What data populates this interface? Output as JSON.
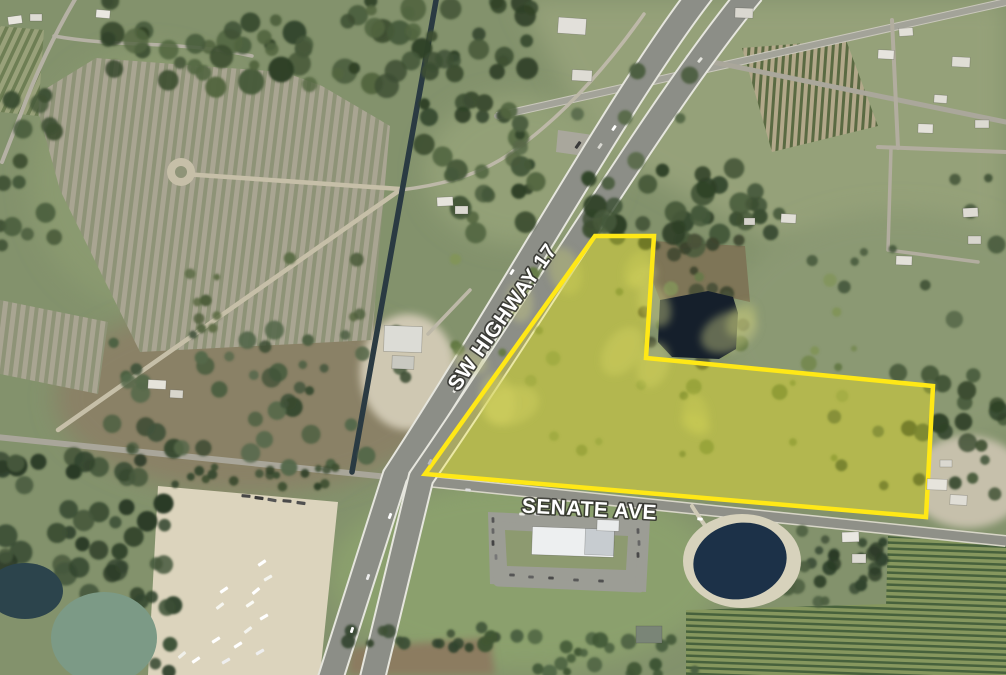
{
  "meta": {
    "title": "Aerial parcel map",
    "subject": "Vacant land parcel at SW Highway 17 and Senate Ave"
  },
  "labels": {
    "highway": {
      "text": "SW HIGHWAY 17",
      "x": 508,
      "y": 321,
      "rotate": -55,
      "size": 21
    },
    "street": {
      "text": "SENATE AVE",
      "x": 589,
      "y": 516,
      "rotate": 3,
      "size": 21
    }
  },
  "parcel": {
    "points": "425,474 595,236 654,236 646,358 933,386 926,517",
    "fill": "rgba(252,238,0,0.26)",
    "stroke": "#ffe816",
    "stroke_width": 4.5
  },
  "base_color": "#83926c",
  "patterns": [
    {
      "id": "pat-field",
      "size": 9,
      "bg": "#a9a592",
      "fg": "#8e9377",
      "fgw": 4,
      "rot": 7
    },
    {
      "id": "pat-corner",
      "size": 8,
      "bg": "#99a17a",
      "fg": "#6e7e54",
      "fgw": 3.5,
      "rot": 25
    },
    {
      "id": "pat-orch1",
      "size": 7,
      "bg": "#b2a88a",
      "fg": "#5a6a42",
      "fgw": 3,
      "rot": 4
    },
    {
      "id": "pat-orch2",
      "size": 6,
      "bg": "#86975e",
      "fg": "#47613c",
      "fgw": 2.5,
      "rot": 92
    }
  ],
  "patches": [
    {
      "name": "pasture-pale-ne",
      "shape": "poly",
      "pts": "520,0 1006,0 1006,255 770,240 600,150",
      "fill": "#95a179",
      "blur": 1
    },
    {
      "name": "pasture-right-mid",
      "shape": "ell",
      "c": [
        900,
        330,
        180,
        120
      ],
      "fill": "#8b9973",
      "blur": 1
    },
    {
      "name": "green-top-left",
      "shape": "ell",
      "c": [
        150,
        180,
        120,
        130
      ],
      "fill": "#8a9a70",
      "blur": 1
    },
    {
      "name": "pasture-brown",
      "shape": "ell",
      "c": [
        250,
        398,
        195,
        95
      ],
      "fill": "#8a8166",
      "blur": 1
    },
    {
      "name": "grass-ne-of-canal",
      "shape": "ell",
      "c": [
        520,
        170,
        95,
        75
      ],
      "fill": "#93a077",
      "blur": 1
    },
    {
      "name": "sand-barn-yard",
      "shape": "ell",
      "c": [
        408,
        372,
        48,
        58
      ],
      "fill": "#cfc8b2",
      "blur": 2
    },
    {
      "name": "grass-bottom",
      "shape": "ell",
      "c": [
        525,
        575,
        195,
        95
      ],
      "fill": "#8ba06d",
      "blur": 1
    },
    {
      "name": "sand-se-houses",
      "shape": "ell",
      "c": [
        968,
        482,
        58,
        46
      ],
      "fill": "#c6c0ab",
      "blur": 2
    },
    {
      "name": "dirt-bottom-strip",
      "shape": "poly",
      "pts": "350,648 490,638 495,675 348,675",
      "fill": "#8c7c60",
      "blur": 2
    },
    {
      "name": "staging-yard",
      "shape": "poly",
      "pts": "158,486 338,502 320,675 148,675",
      "fill": "#dcd4bd",
      "blur": 0
    },
    {
      "name": "highway-pulloff",
      "shape": "poly",
      "pts": "558,130 600,136 598,158 556,152",
      "fill": "#a9a79c",
      "blur": 0
    },
    {
      "name": "parcel-grass",
      "shape": "poly",
      "pts": "425,474 595,236 654,236 646,358 933,386 926,517",
      "fill": "#9aa46b",
      "blur": 0
    },
    {
      "name": "parking-lot",
      "shape": "poly",
      "pts": "488,512 650,520 646,592 490,584",
      "fill": "#9c9d95",
      "blur": 0
    },
    {
      "name": "parking-lawn",
      "shape": "poly",
      "pts": "505,530 628,536 626,570 507,566",
      "fill": "#8d9a70",
      "blur": 0
    },
    {
      "name": "marsh-north-pond",
      "shape": "poly",
      "pts": "652,241 745,246 750,302 710,293 660,300 653,282",
      "fill": "#7e7557",
      "blur": 0
    }
  ],
  "pattern_patches": [
    {
      "name": "plowed-field-main",
      "pts": "34,96 96,58 200,66 284,72 322,86 390,126 380,240 372,340 140,352 60,190",
      "pat": "pat-field"
    },
    {
      "name": "plowed-field-strip",
      "pts": "0,300 108,322 98,394 0,374",
      "pat": "pat-field"
    },
    {
      "name": "orchard-corner-nw",
      "pts": "0,26 44,30 38,116 0,112",
      "pat": "pat-corner"
    },
    {
      "name": "orchard-ne",
      "pts": "742,48 846,40 878,126 772,152",
      "pat": "pat-orch1"
    },
    {
      "name": "orchard-se-east",
      "pts": "888,536 1006,546 1006,675 884,675",
      "pat": "pat-orch2"
    },
    {
      "name": "orchard-se-west",
      "pts": "686,610 888,604 888,675 686,675",
      "pat": "pat-orch2"
    }
  ],
  "roads": [
    {
      "name": "corner-road-v",
      "d": "M77,-4 C58,28 38,68 20,116 L2,162",
      "w": 4,
      "color": "#b5b1a4"
    },
    {
      "name": "corner-road-h",
      "d": "M54,36 C120,48 180,40 252,56",
      "w": 3.5,
      "color": "#b5b1a4"
    },
    {
      "name": "senate-ave-west",
      "d": "M-4,437 L398,478",
      "w": 6,
      "color": "#a9a69a"
    },
    {
      "name": "dirt-road-field",
      "d": "M58,430 L400,190",
      "w": 4.5,
      "color": "#c6bfa8"
    },
    {
      "name": "dirt-road-turnaround-stem",
      "d": "M184,174 L400,189",
      "w": 4.5,
      "color": "#c6bfa8"
    },
    {
      "name": "dirt-turnaround-pad",
      "circle": [
        181,
        172,
        14
      ],
      "color": "#c6bfa8"
    },
    {
      "name": "dirt-turnaround-island",
      "circle": [
        181,
        172,
        6
      ],
      "color": "#8f9478"
    },
    {
      "name": "cross-road-top",
      "d": "M497,116 L1006,2",
      "w": 6,
      "color": "#a3a399",
      "cas": "#c9c7bb",
      "cw": 8
    },
    {
      "name": "branch-road-ne",
      "d": "M688,57 L1006,122",
      "w": 5,
      "color": "#aaa79b"
    },
    {
      "name": "residential-road-v",
      "d": "M892,20 L898,148",
      "w": 4,
      "color": "#b2ad9f"
    },
    {
      "name": "residential-road-h",
      "d": "M878,147 L1006,152",
      "w": 4,
      "color": "#b2ad9f"
    },
    {
      "name": "residential-drive",
      "d": "M891,148 L888,250 L978,262",
      "w": 3.5,
      "color": "#b2ad9f"
    },
    {
      "name": "frontage-road",
      "d": "M644,14 C610,62 560,122 500,160 C470,178 435,186 400,190 M470,290 L428,334",
      "w": 3.5,
      "color": "#bdb8a8"
    },
    {
      "name": "canal",
      "d": "M437,-5 L352,472",
      "w": 5.5,
      "color": "#2a3a42"
    },
    {
      "name": "senate-ave-east",
      "d": "M396,478 L1006,541",
      "w": 9,
      "color": "#8f9088",
      "cas": "#d8d6c8",
      "cw": 12
    },
    {
      "name": "highway-17-southbound",
      "d": "M702,-8 C622,95 510,300 395,476 L330,680",
      "w": 23,
      "color": "#8c8e87",
      "cas": "#e6e6de",
      "cw": 27
    },
    {
      "name": "highway-17-northbound",
      "d": "M752,-8 C662,100 536,312 421,478 L372,680",
      "w": 23,
      "color": "#8c8e87",
      "cas": "#e6e6de",
      "cw": 27
    },
    {
      "name": "pond-access-path",
      "d": "M692,506 C700,520 712,532 716,548",
      "w": 4,
      "color": "#cfcab6"
    },
    {
      "name": "office-driveway-west",
      "d": "M560,506 L562,521",
      "w": 5,
      "color": "#9c9d95"
    },
    {
      "name": "office-driveway-east",
      "d": "M620,510 L623,524",
      "w": 5,
      "color": "#9c9d95"
    },
    {
      "name": "office-parking-loop",
      "d": "M497,517 L642,524 L640,588 L498,582 Z",
      "w": 9,
      "color": "#9c9d95"
    }
  ],
  "waters": [
    {
      "name": "retention-pond-parcel",
      "shape": "poly",
      "pts": "660,300 708,291 733,297 738,313 736,349 719,359 672,357 658,342",
      "fill": "#151f2b"
    },
    {
      "name": "pond-sand-ring",
      "shape": "ell",
      "c": [
        742,
        561,
        59,
        47
      ],
      "fill": "#d7d2bc"
    },
    {
      "name": "pond-office",
      "shape": "ell",
      "c": [
        740,
        561,
        47,
        38
      ],
      "fill": "#1c3148",
      "rot": -12
    },
    {
      "name": "pond-teal-sw",
      "shape": "ell",
      "c": [
        104,
        638,
        53,
        46
      ],
      "fill": "#7c9a86"
    },
    {
      "name": "pond-dark-sw",
      "shape": "ell",
      "c": [
        25,
        591,
        38,
        28
      ],
      "fill": "#2c444c"
    }
  ],
  "veg_clusters": [
    {
      "name": "trees-top-strip",
      "box": [
        108,
        0,
        330,
        88
      ],
      "n": 55,
      "r": [
        5,
        13
      ],
      "cols": [
        "#3c4e32",
        "#46593a",
        "#2f4128",
        "#526540"
      ],
      "seed": 11
    },
    {
      "name": "trees-canal-top",
      "box": [
        430,
        0,
        112,
        80
      ],
      "n": 20,
      "r": [
        5,
        11
      ],
      "cols": [
        "#3c4e32",
        "#46593a",
        "#2f4128"
      ],
      "seed": 22
    },
    {
      "name": "trees-canal-mid",
      "box": [
        424,
        95,
        122,
        145
      ],
      "n": 30,
      "r": [
        5,
        11
      ],
      "cols": [
        "#3c4e32",
        "#46593a",
        "#2f4128",
        "#526540"
      ],
      "seed": 33
    },
    {
      "name": "trees-left-edge",
      "box": [
        0,
        92,
        62,
        170
      ],
      "n": 15,
      "r": [
        5,
        10
      ],
      "cols": [
        "#3c4e32",
        "#46593a"
      ],
      "seed": 44
    },
    {
      "name": "bushes-field",
      "box": [
        190,
        255,
        170,
        80
      ],
      "n": 12,
      "r": [
        3,
        7
      ],
      "cols": [
        "#5c6b45",
        "#4e5e3c"
      ],
      "seed": 55
    },
    {
      "name": "trees-pasture",
      "box": [
        112,
        325,
        300,
        145
      ],
      "n": 48,
      "r": [
        4,
        10
      ],
      "cols": [
        "#41523a",
        "#4c5f41",
        "#37482f",
        "#55684a"
      ],
      "seed": 66
    },
    {
      "name": "trees-north-parcel",
      "box": [
        588,
        168,
        200,
        78
      ],
      "n": 40,
      "r": [
        6,
        12
      ],
      "cols": [
        "#3c4e32",
        "#46593a",
        "#2f4128"
      ],
      "seed": 77
    },
    {
      "name": "trees-pond-ring",
      "box": [
        644,
        236,
        112,
        132
      ],
      "n": 20,
      "r": [
        4,
        8
      ],
      "cols": [
        "#4a5138",
        "#3c442e"
      ],
      "seed": 88
    },
    {
      "name": "trees-east-parcel",
      "box": [
        930,
        372,
        76,
        112
      ],
      "n": 15,
      "r": [
        5,
        10
      ],
      "cols": [
        "#3c4e32",
        "#46593a",
        "#2f4128"
      ],
      "seed": 99
    },
    {
      "name": "trees-right-scatter",
      "box": [
        812,
        165,
        194,
        335
      ],
      "n": 22,
      "r": [
        4,
        9
      ],
      "cols": [
        "#4d5f41",
        "#56694a",
        "#44553a"
      ],
      "seed": 101
    },
    {
      "name": "trees-ne-pasture",
      "box": [
        520,
        55,
        210,
        125
      ],
      "n": 8,
      "r": [
        5,
        9
      ],
      "cols": [
        "#4c5e40",
        "#556847"
      ],
      "seed": 103
    },
    {
      "name": "scrub-bottom-left",
      "box": [
        0,
        452,
        172,
        145
      ],
      "n": 45,
      "r": [
        6,
        12
      ],
      "cols": [
        "#33452e",
        "#2b3b27",
        "#3d5036",
        "#46583c"
      ],
      "seed": 107
    },
    {
      "name": "scrub-bottom-left-2",
      "box": [
        130,
        595,
        50,
        80
      ],
      "n": 8,
      "r": [
        5,
        9
      ],
      "cols": [
        "#33452e",
        "#3d5036"
      ],
      "seed": 109
    },
    {
      "name": "hedgerow-yard",
      "box": [
        175,
        467,
        175,
        20
      ],
      "n": 18,
      "r": [
        3,
        5
      ],
      "cols": [
        "#3c4e32",
        "#2f4128"
      ],
      "seed": 113
    },
    {
      "name": "tree-row-bottom",
      "box": [
        348,
        626,
        150,
        22
      ],
      "n": 16,
      "r": [
        4,
        7
      ],
      "cols": [
        "#33452e",
        "#3d5036"
      ],
      "seed": 127
    },
    {
      "name": "hedge-bottom-center",
      "box": [
        485,
        635,
        210,
        40
      ],
      "n": 24,
      "r": [
        4,
        8
      ],
      "cols": [
        "#3f5534",
        "#4a6040"
      ],
      "seed": 131
    },
    {
      "name": "bushes-parcel",
      "box": [
        455,
        255,
        400,
        210
      ],
      "n": 34,
      "r": [
        3,
        8
      ],
      "cols": [
        "#74884e",
        "#647a46",
        "#82945a"
      ],
      "seed": 137
    },
    {
      "name": "trees-office-pond",
      "box": [
        780,
        512,
        72,
        95
      ],
      "n": 12,
      "r": [
        4,
        8
      ],
      "cols": [
        "#41523a",
        "#4c5f41"
      ],
      "seed": 139
    },
    {
      "name": "trees-farmstead-se",
      "box": [
        820,
        542,
        68,
        66
      ],
      "n": 16,
      "r": [
        4,
        8
      ],
      "cols": [
        "#33452e",
        "#2b3b27",
        "#3d5036"
      ],
      "seed": 149
    }
  ],
  "blotches": {
    "name": "parcel-grass-highlights",
    "box": [
      470,
      268,
      390,
      190
    ],
    "n": 14,
    "r": [
      14,
      32
    ],
    "cols": [
      "#c6c882",
      "#bac073"
    ],
    "seed": 171,
    "op": 0.45
  },
  "buildings": [
    [
      8,
      16,
      14,
      8,
      -8,
      "#e8e6de"
    ],
    [
      30,
      14,
      12,
      7,
      0,
      "#dddbd3"
    ],
    [
      96,
      10,
      14,
      8,
      5,
      "#e9e7e1"
    ],
    [
      384,
      326,
      38,
      26,
      2,
      "#dcdcd6"
    ],
    [
      392,
      356,
      22,
      13,
      2,
      "#c9c9c1"
    ],
    [
      437,
      197,
      16,
      9,
      -3,
      "#e6e4dc"
    ],
    [
      455,
      206,
      13,
      8,
      0,
      "#dcdad2"
    ],
    [
      148,
      380,
      18,
      9,
      3,
      "#e5e3da"
    ],
    [
      170,
      390,
      13,
      8,
      3,
      "#d8d6cc"
    ],
    [
      558,
      18,
      28,
      16,
      4,
      "#e2e0da"
    ],
    [
      572,
      70,
      20,
      11,
      3,
      "#dedcd4"
    ],
    [
      735,
      8,
      18,
      10,
      2,
      "#dad8d0"
    ],
    [
      878,
      50,
      16,
      9,
      3,
      "#e6e4de"
    ],
    [
      899,
      28,
      14,
      8,
      -4,
      "#e2e0d8"
    ],
    [
      952,
      57,
      18,
      10,
      3,
      "#dfddd5"
    ],
    [
      918,
      124,
      15,
      9,
      2,
      "#e4e2da"
    ],
    [
      975,
      120,
      14,
      8,
      0,
      "#dcdad2"
    ],
    [
      934,
      95,
      13,
      8,
      4,
      "#e0ded6"
    ],
    [
      896,
      256,
      16,
      9,
      2,
      "#e3e1d9"
    ],
    [
      963,
      208,
      15,
      9,
      -3,
      "#dedcd4"
    ],
    [
      968,
      236,
      13,
      8,
      0,
      "#d8d6ce"
    ],
    [
      781,
      214,
      15,
      9,
      3,
      "#e1dfd7"
    ],
    [
      744,
      218,
      11,
      7,
      0,
      "#d6d4cc"
    ],
    [
      927,
      479,
      20,
      11,
      2,
      "#e6e4dc"
    ],
    [
      950,
      495,
      17,
      10,
      3,
      "#e0ded6"
    ],
    [
      940,
      460,
      12,
      7,
      0,
      "#dad8d0"
    ],
    [
      532,
      528,
      82,
      28,
      2,
      "#edeff0"
    ],
    [
      585,
      529,
      29,
      26,
      2,
      "#c7ccd0"
    ],
    [
      597,
      520,
      22,
      11,
      2,
      "#e9ebeb"
    ],
    [
      636,
      626,
      26,
      17,
      0,
      "#7a8577"
    ],
    [
      842,
      532,
      17,
      10,
      -2,
      "#e9e7e1"
    ],
    [
      852,
      554,
      14,
      9,
      0,
      "#dddbd3"
    ]
  ],
  "vehicles": [
    [
      246,
      496,
      5,
      "#474747",
      9
    ],
    [
      259,
      498,
      8,
      "#3a3a3a",
      9
    ],
    [
      272,
      500,
      10,
      "#555555",
      9
    ],
    [
      287,
      501,
      5,
      "#4a4a4a",
      9
    ],
    [
      301,
      503,
      8,
      "#505050",
      9
    ],
    [
      262,
      563,
      -35,
      "#ffffff",
      9
    ],
    [
      268,
      578,
      -30,
      "#f4f4ee",
      9
    ],
    [
      256,
      591,
      -40,
      "#ffffff",
      9
    ],
    [
      250,
      604,
      -35,
      "#fafaf4",
      9
    ],
    [
      264,
      617,
      -30,
      "#ffffff",
      9
    ],
    [
      248,
      630,
      -38,
      "#f4f4ee",
      9
    ],
    [
      238,
      645,
      -32,
      "#ffffff",
      9
    ],
    [
      260,
      652,
      -30,
      "#eeeeee",
      9
    ],
    [
      224,
      590,
      -35,
      "#ffffff",
      9
    ],
    [
      220,
      606,
      -38,
      "#f6f6f0",
      9
    ],
    [
      216,
      640,
      -32,
      "#ffffff",
      9
    ],
    [
      226,
      661,
      -30,
      "#eeeeee",
      9
    ],
    [
      196,
      660,
      -35,
      "#ffffff",
      9
    ],
    [
      182,
      655,
      -40,
      "#f0f0ea",
      9
    ],
    [
      493,
      520,
      88,
      "#555555",
      5.5
    ],
    [
      493,
      531,
      88,
      "#666666",
      5.5
    ],
    [
      493,
      543,
      88,
      "#444444",
      5.5
    ],
    [
      496,
      557,
      88,
      "#777777",
      5.5
    ],
    [
      512,
      575,
      2,
      "#555555",
      5.5
    ],
    [
      531,
      577,
      2,
      "#606060",
      5.5
    ],
    [
      551,
      578,
      2,
      "#4a4a4a",
      5.5
    ],
    [
      576,
      580,
      2,
      "#585858",
      5.5
    ],
    [
      601,
      581,
      2,
      "#505050",
      5.5
    ],
    [
      638,
      531,
      88,
      "#5a5a5a",
      5.5
    ],
    [
      639,
      543,
      88,
      "#666666",
      5.5
    ],
    [
      638,
      555,
      88,
      "#484848",
      5.5
    ],
    [
      522,
      514,
      2,
      "#e8e8e2",
      5.5
    ],
    [
      537,
      514,
      2,
      "#dddddd",
      5.5
    ],
    [
      614,
      128,
      -55,
      "#ffffff",
      6
    ],
    [
      600,
      146,
      -55,
      "#d8d8d2",
      6
    ],
    [
      512,
      272,
      -57,
      "#ffffff",
      6
    ],
    [
      455,
      390,
      -60,
      "#e8e8e2",
      6
    ],
    [
      430,
      462,
      -62,
      "#bbbbbb",
      6
    ],
    [
      390,
      516,
      -68,
      "#ffffff",
      6
    ],
    [
      368,
      577,
      -70,
      "#eeeeee",
      6
    ],
    [
      352,
      630,
      -72,
      "#ffffff",
      6
    ],
    [
      700,
      60,
      -50,
      "#e5e5df",
      6
    ],
    [
      578,
      145,
      -55,
      "#3a3a3a",
      8
    ],
    [
      468,
      490,
      6,
      "#dddddd",
      5.5
    ],
    [
      700,
      519,
      5,
      "#ffffff",
      5.5
    ]
  ]
}
